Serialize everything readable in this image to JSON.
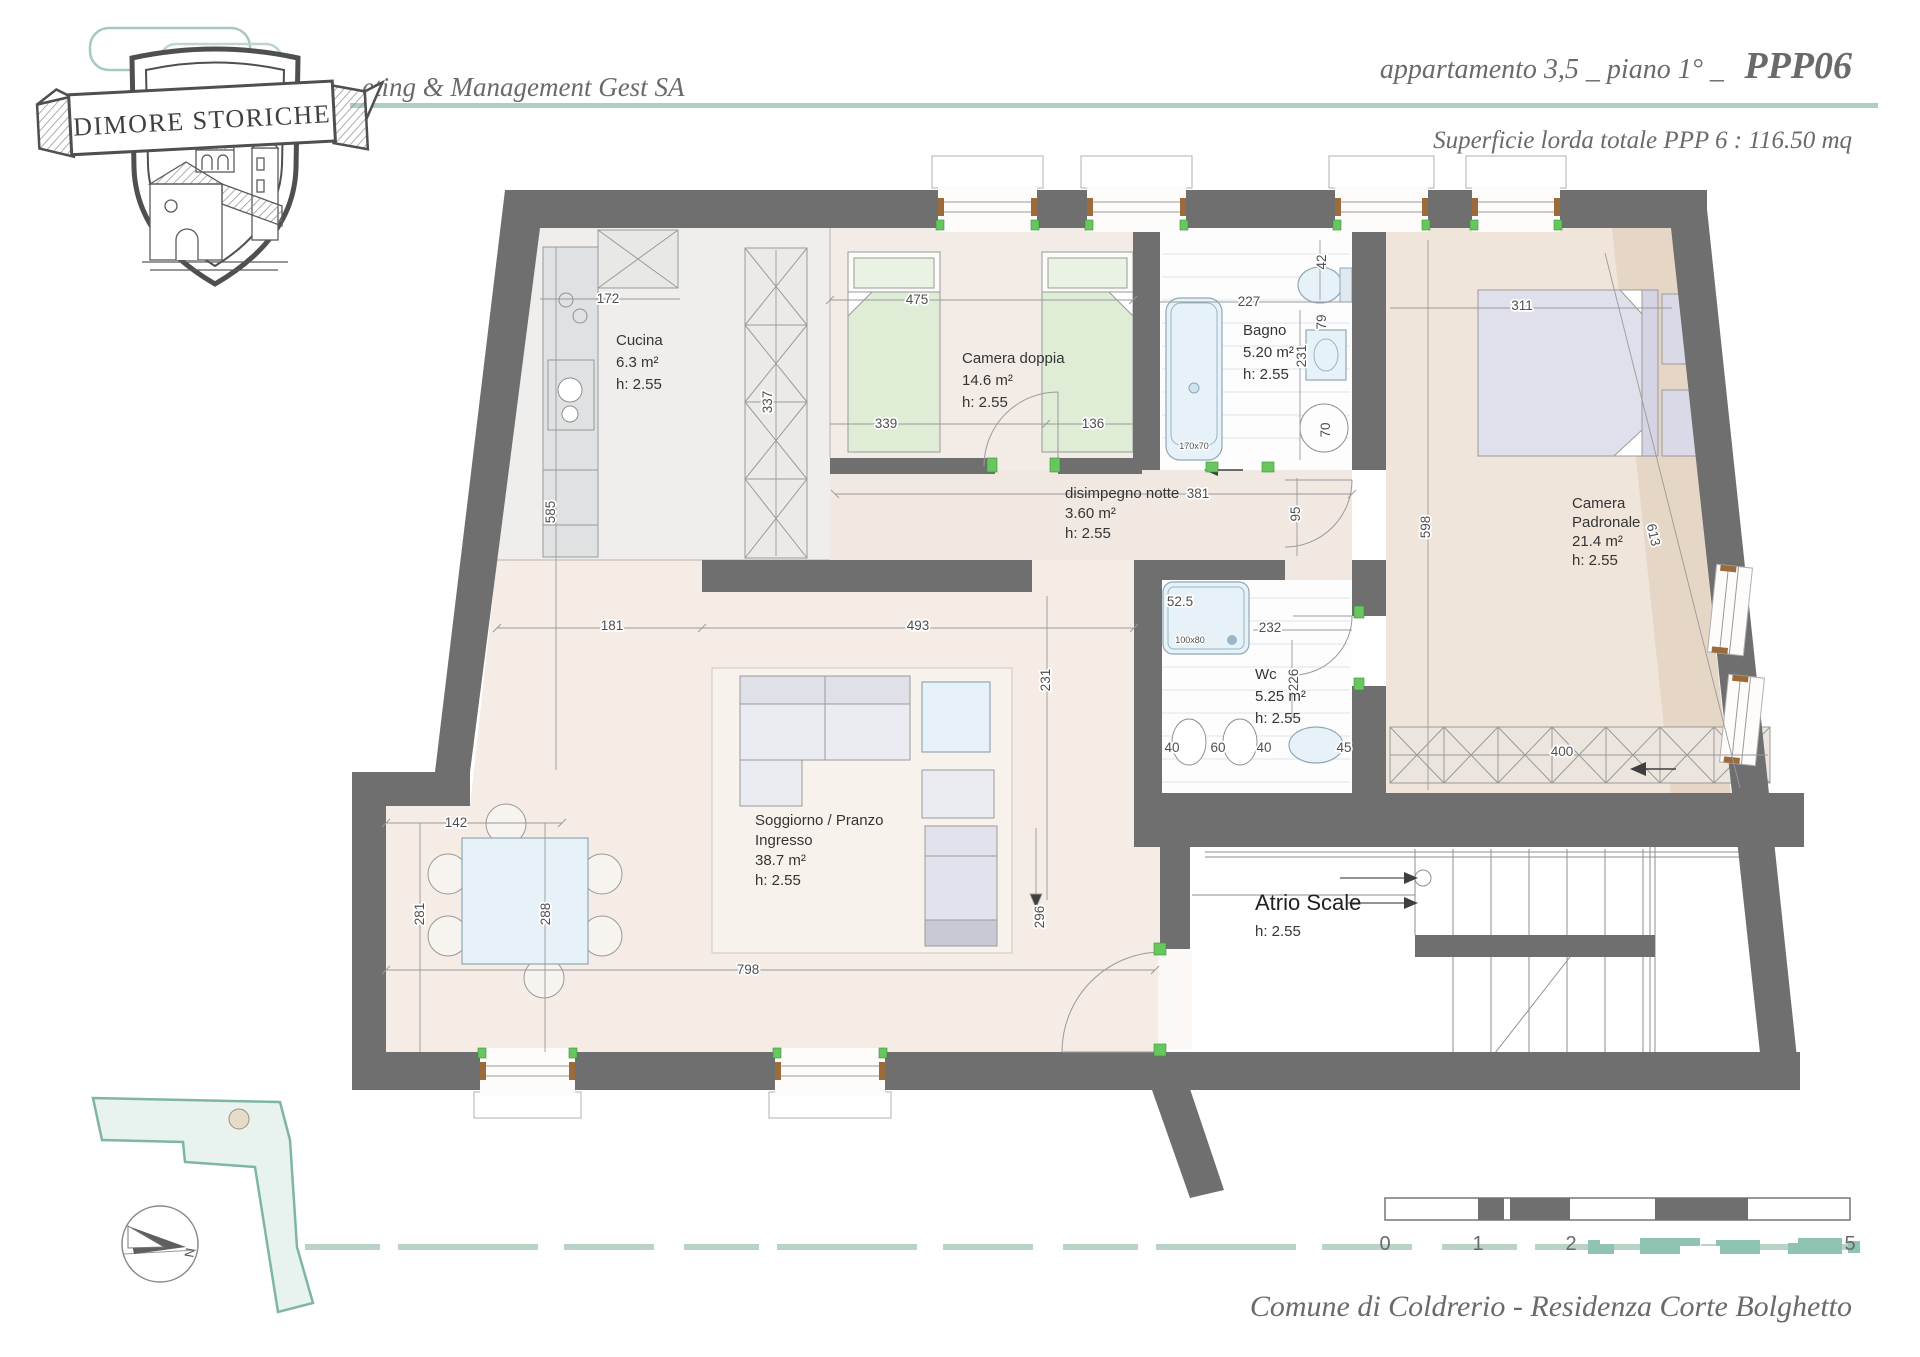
{
  "header": {
    "watermark": "eting & Management Gest SA",
    "title": "appartamento 3,5 _ piano 1° _",
    "code": "PPP06",
    "subtitle": "Superficie lorda totale PPP 6 : 116.50 mq"
  },
  "logo": {
    "name": "DIMORE STORICHE"
  },
  "plan": {
    "rooms": [
      {
        "name": "Cucina",
        "area": "6.3 m²",
        "height": "h: 2.55"
      },
      {
        "name": "Camera doppia",
        "area": "14.6 m²",
        "height": "h: 2.55"
      },
      {
        "name": "Bagno",
        "area": "5.20 m²",
        "height": "h: 2.55"
      },
      {
        "name": "disimpegno notte",
        "area": "3.60 m²",
        "height": "h: 2.55"
      },
      {
        "name": "Camera",
        "name2": "Padronale",
        "area": "21.4 m²",
        "height": "h: 2.55"
      },
      {
        "name": "Wc",
        "area": "5.25 m²",
        "height": "h: 2.55"
      },
      {
        "name": "Soggiorno / Pranzo",
        "name2": "Ingresso",
        "area": "38.7 m²",
        "height": "h: 2.55"
      },
      {
        "name": "Atrio Scale",
        "height": "h: 2.55"
      }
    ],
    "dims": [
      "172",
      "585",
      "475",
      "337",
      "339",
      "136",
      "227",
      "42",
      "79",
      "231",
      "70",
      "311",
      "598",
      "613",
      "381",
      "95",
      "52.5",
      "100x80",
      "232",
      "226",
      "40",
      "60",
      "40",
      "45",
      "400",
      "181",
      "493",
      "231",
      "142",
      "281",
      "288",
      "798",
      "296",
      "170x70"
    ]
  },
  "scalebar": {
    "labels": [
      "0",
      "1",
      "2",
      "5"
    ]
  },
  "compass": {
    "label": "N"
  },
  "footer": {
    "location": "Comune di Coldrerio - Residenza Corte Bolghetto"
  }
}
